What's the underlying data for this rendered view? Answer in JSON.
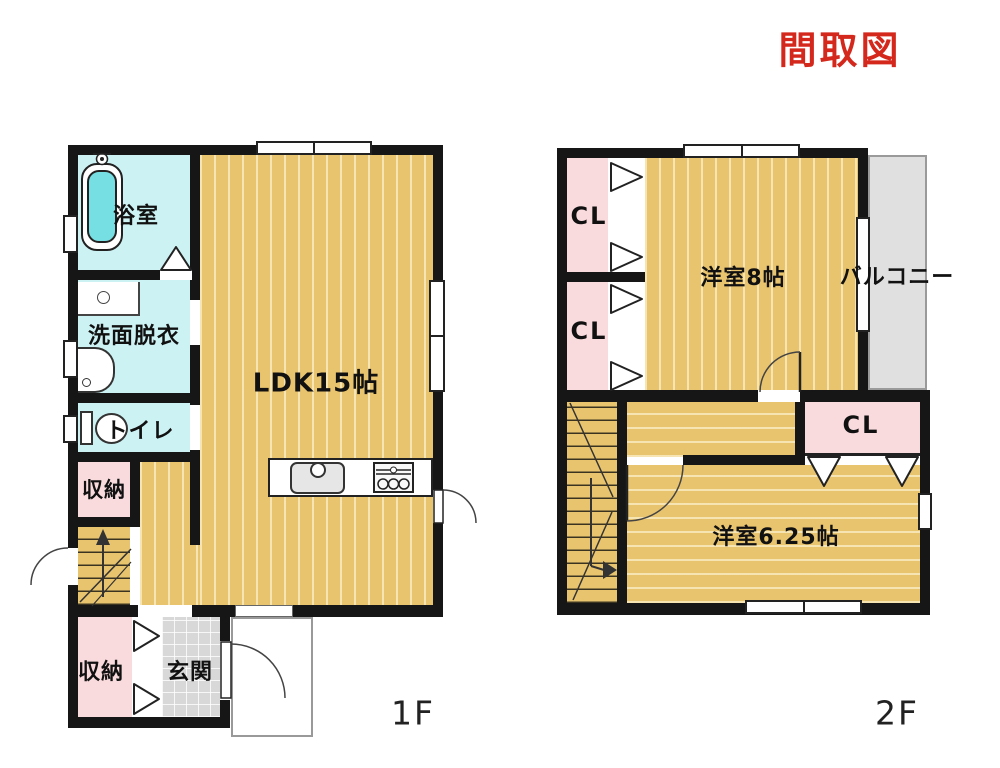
{
  "title": "間取図",
  "colors": {
    "title_red": "#d4281c",
    "wall_black": "#161616",
    "floor_tan": "#e9c46e",
    "floor_cyan": "#cdf2f4",
    "floor_pink": "#fadbdd",
    "entry_tile_gray": "#d8d8d8",
    "balcony_gray": "#e0e0e0",
    "bathtub_cyan": "#76dfe4"
  },
  "floor1": {
    "label": "1F",
    "rooms": {
      "bath": "浴室",
      "washroom": "洗面脱衣",
      "toilet": "トイレ",
      "storage_upper": "収納",
      "ldk": "LDK15帖",
      "storage_lower": "収納",
      "entrance": "玄関"
    }
  },
  "floor2": {
    "label": "2F",
    "rooms": {
      "closet_top": "CL",
      "closet_mid": "CL",
      "bedroom_8": "洋室8帖",
      "balcony": "バルコニー",
      "closet_right": "CL",
      "bedroom_625": "洋室6.25帖"
    }
  }
}
